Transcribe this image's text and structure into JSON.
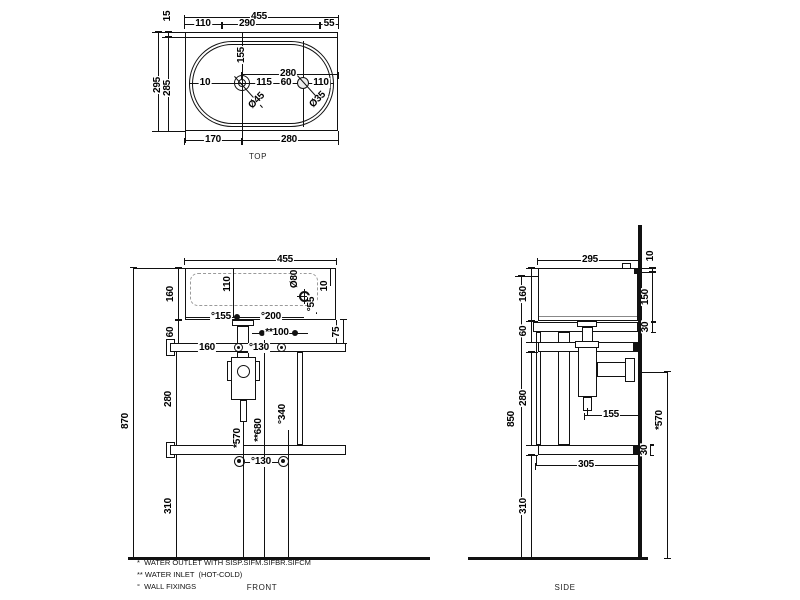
{
  "views": {
    "top": {
      "caption": "TOP",
      "dims": {
        "w455": "455",
        "w110": "110",
        "w290": "290",
        "w55": "55",
        "h15": "15",
        "h295": "295",
        "h285": "285",
        "g10": "10",
        "v155": "155",
        "w115": "115",
        "i280": "280",
        "w60": "60",
        "r110": "110",
        "dia45": "Ø45",
        "dia35": "Ø35",
        "b170": "170",
        "b280": "280"
      }
    },
    "front": {
      "caption": "FRONT",
      "dims": {
        "w455": "455",
        "v110": "110",
        "dia80": "Ø80",
        "g10": "10",
        "f55": "°55",
        "h160": "160",
        "h60": "60",
        "f155": "°155",
        "f200": "°200",
        "in100": "**100",
        "v75": "75",
        "r160": "160",
        "f130": "°130",
        "h280": "280",
        "h870": "870",
        "o570": "*570",
        "i680": "**680",
        "f340": "°340",
        "f130b": "°130",
        "h310": "310"
      }
    },
    "side": {
      "caption": "SIDE",
      "dims": {
        "w295": "295",
        "g10": "10",
        "v150": "150",
        "v30": "30",
        "h160": "160",
        "h60": "60",
        "h280": "280",
        "h850": "850",
        "p155": "155",
        "v30b": "30",
        "w305": "305",
        "o570": "*570",
        "h310": "310"
      }
    }
  },
  "footnotes": [
    "*  WATER OUTLET WITH SISP.SIFM.SIFBR.SIFCM",
    "** WATER INLET  (HOT-COLD)",
    "°  WALL FIXINGS"
  ]
}
